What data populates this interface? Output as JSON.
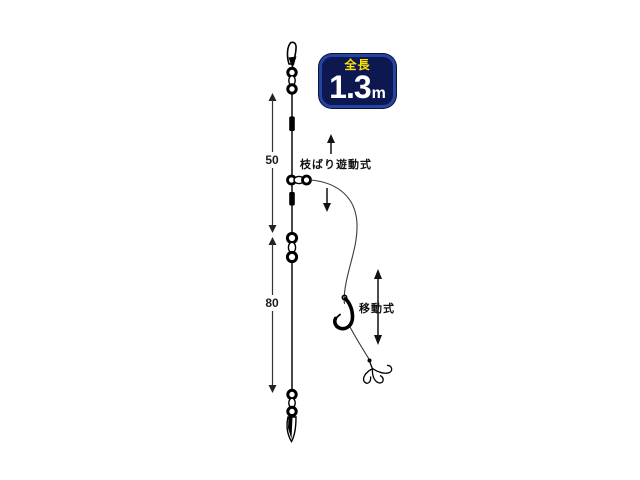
{
  "badge": {
    "label": "全長",
    "value": "1.3",
    "unit": "m",
    "bg_color": "#0d1850",
    "border_color": "#2444a3",
    "label_color": "#ffe400",
    "value_color": "#ffffff"
  },
  "measurements": {
    "upper": "50",
    "lower": "80"
  },
  "annotations": {
    "branch_slide": "枝ばり遊動式",
    "movable": "移動式"
  },
  "diagram": {
    "background": "#ffffff",
    "line_color": "#1a1a1a",
    "parts": {
      "top": "snap-swivel",
      "upper_stopper": "stopper-bead",
      "branch": "sliding-branch-swivel",
      "lower_stopper": "stopper-bead",
      "middle": "barrel-swivel",
      "bottom": "snap-swivel",
      "branch_end": "single-hook",
      "terminal": "treble-hook"
    }
  }
}
